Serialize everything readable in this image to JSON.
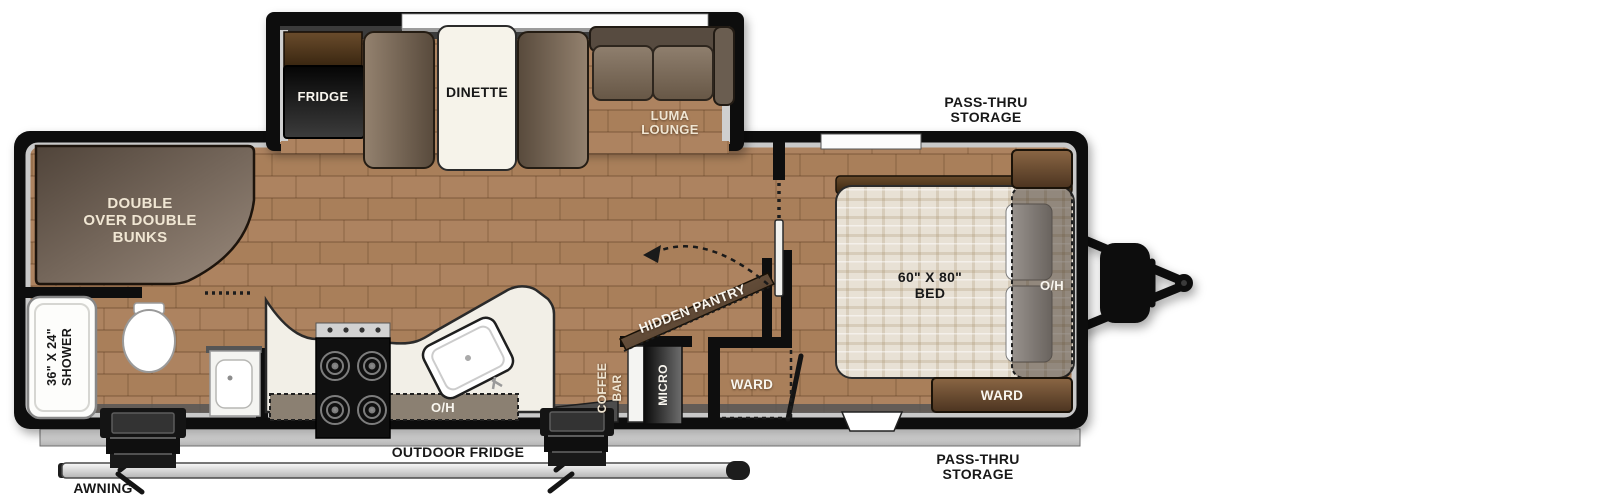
{
  "diagram": {
    "type": "rv-travel-trailer-floorplan",
    "colors": {
      "wall": "#0e0e0e",
      "floor": "#a97f5a",
      "counter": "#f2efe7",
      "furniture_brown": "#6e5844",
      "mattress": "#e8e1d5",
      "lining_light": "#c9c9c9",
      "lining_dark": "#565656",
      "label_dark": "#181818",
      "label_cream": "#f0e6d3"
    },
    "labels": {
      "fridge": "FRIDGE",
      "dinette": "DINETTE",
      "luma": [
        "LUMA",
        "LOUNGE"
      ],
      "bunks": [
        "DOUBLE",
        "OVER DOUBLE",
        "BUNKS"
      ],
      "shower": [
        "36\" X 24\"",
        "SHOWER"
      ],
      "bed": [
        "60\" X 80\"",
        "BED"
      ],
      "bed_overhead": "O/H",
      "kitchen_overhead": "O/H",
      "ward_bedroom": "WARD",
      "ward_hall": "WARD",
      "hidden_pantry": "HIDDEN PANTRY",
      "coffee_bar": [
        "COFFEE",
        "BAR"
      ],
      "micro": "MICRO",
      "outdoor_fridge": "OUTDOOR FRIDGE",
      "pass_thru_top": [
        "PASS-THRU",
        "STORAGE"
      ],
      "pass_thru_bottom": [
        "PASS-THRU",
        "STORAGE"
      ],
      "awning": "AWNING"
    }
  }
}
